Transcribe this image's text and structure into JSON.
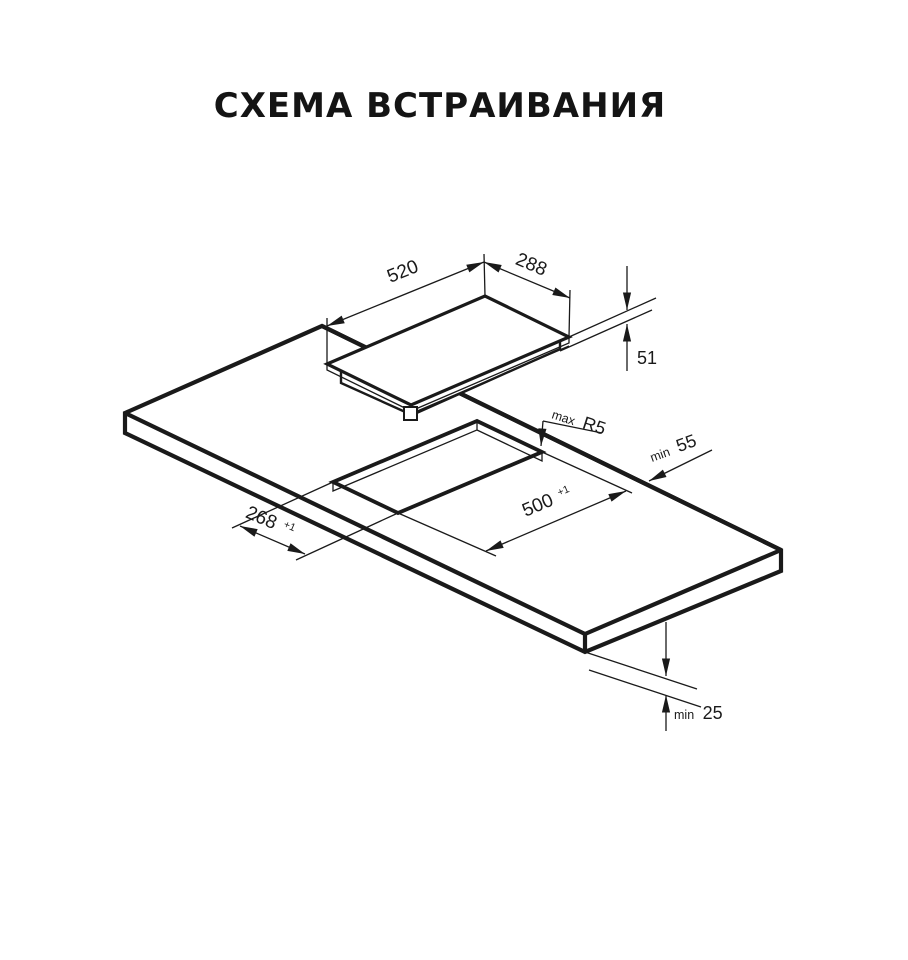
{
  "title": "СХЕМА ВСТРАИВАНИЯ",
  "colors": {
    "line": "#1a1a1a",
    "background": "#ffffff",
    "title": "#141414"
  },
  "dimensions": {
    "cooktop_width": {
      "value": "520"
    },
    "cooktop_depth": {
      "value": "288"
    },
    "cooktop_height": {
      "value": "51"
    },
    "cutout_length": {
      "value": "500",
      "tolerance": "+1"
    },
    "cutout_width": {
      "value": "268",
      "tolerance": "+1"
    },
    "corner_radius": {
      "qualifier": "max",
      "value": "R5"
    },
    "side_clearance": {
      "qualifier": "min",
      "value": "55"
    },
    "bottom_clearance": {
      "qualifier": "min",
      "value": "25"
    }
  }
}
